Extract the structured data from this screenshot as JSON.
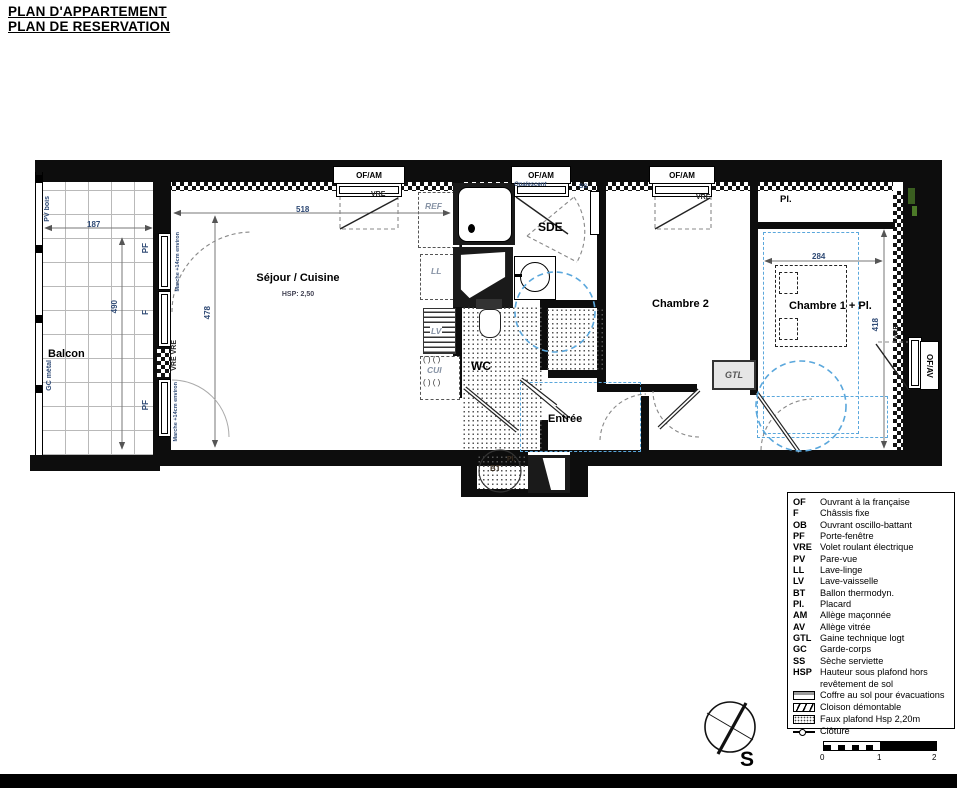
{
  "title": {
    "line1": "PLAN D'APPARTEMENT",
    "line2": "PLAN DE RESERVATION"
  },
  "rooms": {
    "balcon": "Balcon",
    "sejour": "Séjour / Cuisine",
    "sejour_hsp": "HSP: 2,50",
    "sde": "SDE",
    "wc": "WC",
    "entree": "Entrée",
    "chambre2": "Chambre 2",
    "chambre1": "Chambre 1 + Pl.",
    "placard_top": "Pl.",
    "placard_bt": "Pl.",
    "bt": "BT",
    "gtl": "GTL"
  },
  "windows_top": [
    {
      "label": "OF/AM",
      "vre": "VRE"
    },
    {
      "label": "OF/AM",
      "note": "Opalescent",
      "ss": "SS"
    },
    {
      "label": "OF/AM",
      "vre": "VRE"
    }
  ],
  "window_right": {
    "label": "OF/AV",
    "vre": "VRE"
  },
  "annotations": {
    "ref": "REF",
    "ll": "LL",
    "lv": "LV",
    "cui": "CUI",
    "burners_row1": "( ) ( )",
    "burners_row2": "( ) ( )",
    "pv_bois": "PV bois",
    "gc_metal": "GC métal",
    "pf_top": "PF",
    "f_mid": "F",
    "pf_bottom": "PF",
    "vre_vre": "VRE VRE",
    "marche_top": "Marche +14cm environ",
    "marche_bottom": "Marche +14cm environ"
  },
  "dimensions": {
    "balcon_w": "187",
    "balcon_h": "490",
    "sejour_w": "518",
    "sejour_h": "478",
    "chambre1_w": "284",
    "chambre1_h": "418"
  },
  "legend": {
    "items": [
      {
        "abbr": "OF",
        "desc": "Ouvrant à la française"
      },
      {
        "abbr": "F",
        "desc": "Châssis fixe"
      },
      {
        "abbr": "OB",
        "desc": "Ouvrant oscillo-battant"
      },
      {
        "abbr": "PF",
        "desc": "Porte-fenêtre"
      },
      {
        "abbr": "VRE",
        "desc": "Volet roulant électrique"
      },
      {
        "abbr": "PV",
        "desc": "Pare-vue"
      },
      {
        "abbr": "LL",
        "desc": "Lave-linge"
      },
      {
        "abbr": "LV",
        "desc": "Lave-vaisselle"
      },
      {
        "abbr": "BT",
        "desc": "Ballon thermodyn."
      },
      {
        "abbr": "Pl.",
        "desc": "Placard"
      },
      {
        "abbr": "AM",
        "desc": "Allège maçonnée"
      },
      {
        "abbr": "AV",
        "desc": "Allège vitrée"
      },
      {
        "abbr": "GTL",
        "desc": "Gaine technique logt"
      },
      {
        "abbr": "GC",
        "desc": "Garde-corps"
      },
      {
        "abbr": "SS",
        "desc": "Sèche serviette"
      },
      {
        "abbr": "HSP",
        "desc": "Hauteur sous plafond hors revêtement de sol"
      }
    ],
    "symbols": [
      {
        "desc": "Coffre au sol pour évacuations"
      },
      {
        "desc": "Cloison démontable"
      },
      {
        "desc": "Faux plafond Hsp 2,20m"
      },
      {
        "desc": "Clôture"
      }
    ]
  },
  "compass": {
    "south": "S"
  },
  "scalebar": {
    "ticks": [
      "0",
      "1",
      "2"
    ]
  },
  "colors": {
    "wall": "#0d0d0d",
    "annotation_blue": "#2f4a75",
    "faux_plafond_blue": "#5aa7dc",
    "appliance_gray": "#8793a5",
    "accent_green": "#3a5e20"
  }
}
